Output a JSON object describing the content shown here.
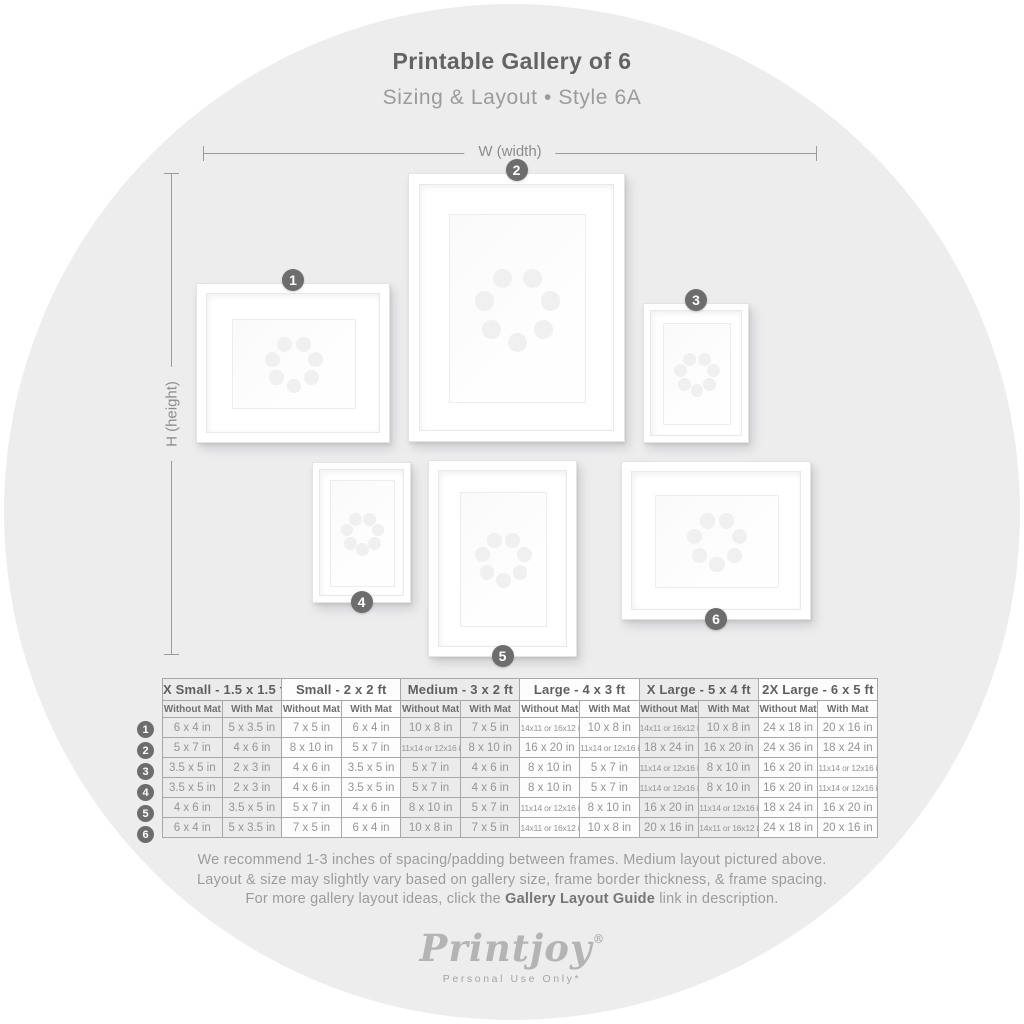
{
  "header": {
    "title": "Printable Gallery of 6",
    "subtitle": "Sizing & Layout • Style 6A"
  },
  "dimensions": {
    "width_label": "W (width)",
    "height_label": "H (height)"
  },
  "gallery": {
    "frames": [
      {
        "num": "1"
      },
      {
        "num": "2"
      },
      {
        "num": "3"
      },
      {
        "num": "4"
      },
      {
        "num": "5"
      },
      {
        "num": "6"
      }
    ]
  },
  "table": {
    "groups": [
      {
        "label": "X Small - 1.5 x 1.5 ft",
        "tinted": true
      },
      {
        "label": "Small - 2 x 2 ft",
        "tinted": false
      },
      {
        "label": "Medium - 3 x 2 ft",
        "tinted": true
      },
      {
        "label": "Large - 4 x 3 ft",
        "tinted": false
      },
      {
        "label": "X Large - 5 x 4 ft",
        "tinted": true
      },
      {
        "label": "2X Large - 6 x 5 ft",
        "tinted": false
      }
    ],
    "subheaders": [
      "Without Mat",
      "With Mat"
    ],
    "rows": [
      {
        "num": "1",
        "cells": [
          "6 x 4 in",
          "5 x 3.5 in",
          "7 x 5 in",
          "6 x 4 in",
          "10 x 8 in",
          "7 x 5 in",
          "14x11 or 16x12 in",
          "10 x 8 in",
          "14x11 or 16x12 in",
          "10 x 8 in",
          "24 x 18 in",
          "20 x 16 in"
        ]
      },
      {
        "num": "2",
        "cells": [
          "5 x 7 in",
          "4 x 6 in",
          "8 x 10 in",
          "5 x 7 in",
          "11x14 or 12x16 in",
          "8 x 10 in",
          "16 x 20 in",
          "11x14 or 12x16 in",
          "18 x 24 in",
          "16 x 20 in",
          "24 x 36 in",
          "18 x 24 in"
        ]
      },
      {
        "num": "3",
        "cells": [
          "3.5 x 5 in",
          "2 x 3 in",
          "4 x 6 in",
          "3.5 x 5 in",
          "5 x 7 in",
          "4 x 6 in",
          "8 x 10 in",
          "5 x 7 in",
          "11x14 or 12x16 in",
          "8 x 10 in",
          "16 x 20 in",
          "11x14 or 12x16 in"
        ]
      },
      {
        "num": "4",
        "cells": [
          "3.5 x 5 in",
          "2 x 3 in",
          "4 x 6 in",
          "3.5 x 5 in",
          "5 x 7 in",
          "4 x 6 in",
          "8 x 10 in",
          "5 x 7 in",
          "11x14 or 12x16 in",
          "8 x 10 in",
          "16 x 20 in",
          "11x14 or 12x16 in"
        ]
      },
      {
        "num": "5",
        "cells": [
          "4 x 6 in",
          "3.5 x 5 in",
          "5 x 7 in",
          "4 x 6 in",
          "8 x 10 in",
          "5 x 7 in",
          "11x14 or 12x16 in",
          "8 x 10 in",
          "16 x 20 in",
          "11x14 or 12x16 in",
          "18 x 24 in",
          "16 x 20 in"
        ]
      },
      {
        "num": "6",
        "cells": [
          "6 x 4 in",
          "5 x 3.5 in",
          "7 x 5 in",
          "6 x 4 in",
          "10 x 8 in",
          "7 x 5 in",
          "14x11 or 16x12 in",
          "10 x 8 in",
          "20 x 16 in",
          "14x11 or 16x12 in",
          "24 x 18 in",
          "20 x 16 in"
        ]
      }
    ]
  },
  "footer": {
    "line1": "We recommend 1-3 inches of spacing/padding between frames. Medium layout pictured above.",
    "line2": "Layout & size may slightly vary based on gallery size, frame border thickness, & frame spacing.",
    "line3_prefix": "For more gallery layout ideas, click the ",
    "line3_bold": "Gallery Layout Guide",
    "line3_suffix": " link in description."
  },
  "brand": {
    "logo": "Printjoy",
    "registered": "®",
    "tagline": "Personal Use Only*"
  },
  "colors": {
    "circle_bg": "#EDEDEE",
    "badge": "#6D6D6D",
    "title_text": "#636363",
    "muted_text": "#9B9B9B",
    "table_border": "#A8A8A8",
    "tinted_column": "#EBEBEC"
  }
}
